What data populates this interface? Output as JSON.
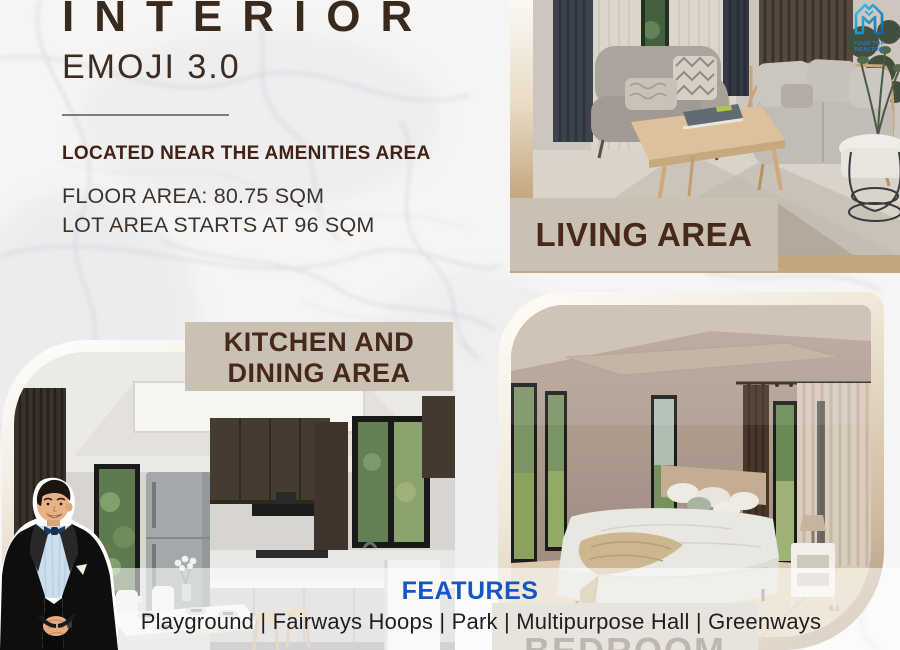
{
  "header": {
    "title": "INTERIOR",
    "subtitle": "EMOJI 3.0",
    "location_note": "LOCATED NEAR THE AMENITIES AREA",
    "floor_area": "FLOOR AREA: 80.75 SQM",
    "lot_area": "LOT AREA STARTS AT 96 SQM"
  },
  "labels": {
    "living": "LIVING AREA",
    "kitchen_line1": "KITCHEN AND",
    "kitchen_line2": "DINING AREA",
    "bedroom": "BEDROOM"
  },
  "features": {
    "heading": "FEATURES",
    "items": [
      "Playground",
      "Fairways Hoops",
      "Park",
      "Multipurpose Hall",
      "Greenways"
    ],
    "list_text": "Playground | Fairways Hoops | Park | Multipurpose Hall | Greenways"
  },
  "logo": {
    "text": "YOUR TOP REALTOR"
  },
  "colors": {
    "title_brown": "#3A2A1E",
    "label_bg": "#CBC1B3",
    "label_text": "#47281C",
    "features_blue": "#1455C8",
    "logo_blue": "#1E7BD4"
  }
}
